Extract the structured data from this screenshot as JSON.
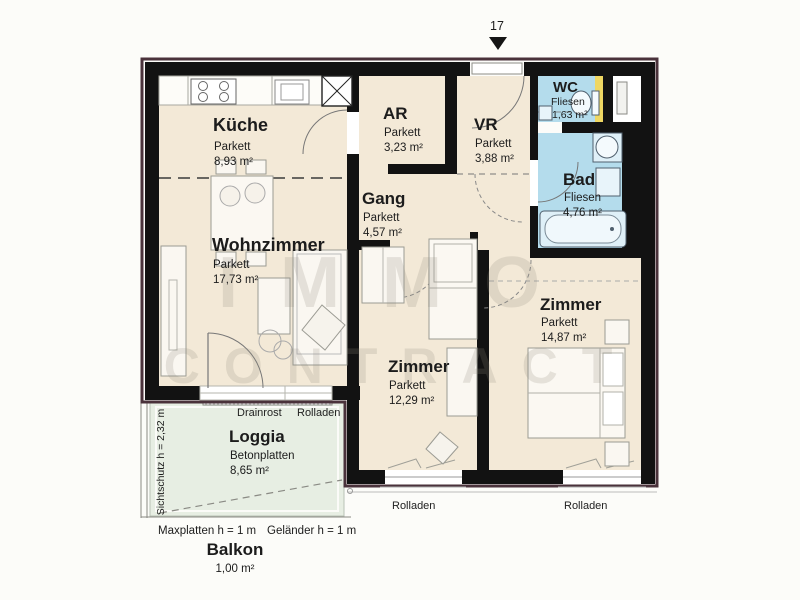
{
  "header": {
    "unit_number": "17"
  },
  "watermark": {
    "line1": "IMMO",
    "line2": "CONTRACT"
  },
  "rooms": {
    "kueche": {
      "name": "Küche",
      "floor": "Parkett",
      "area": "8,93 m²"
    },
    "wohnzimmer": {
      "name": "Wohnzimmer",
      "floor": "Parkett",
      "area": "17,73 m²"
    },
    "ar": {
      "name": "AR",
      "floor": "Parkett",
      "area": "3,23 m²"
    },
    "vr": {
      "name": "VR",
      "floor": "Parkett",
      "area": "3,88 m²"
    },
    "gang": {
      "name": "Gang",
      "floor": "Parkett",
      "area": "4,57 m²"
    },
    "wc": {
      "name": "WC",
      "floor": "Fliesen",
      "area": "1,63 m²"
    },
    "bad": {
      "name": "Bad",
      "floor": "Fliesen",
      "area": "4,76 m²"
    },
    "zimmer_klein": {
      "name": "Zimmer",
      "floor": "Parkett",
      "area": "12,29 m²"
    },
    "zimmer_gross": {
      "name": "Zimmer",
      "floor": "Parkett",
      "area": "14,87 m²"
    },
    "loggia": {
      "name": "Loggia",
      "floor": "Betonplatten",
      "area": "8,65 m²"
    },
    "balkon": {
      "name": "Balkon",
      "area": "1,00 m²"
    }
  },
  "annotations": {
    "drainrost": "Drainrost",
    "rolladen_top": "Rolladen",
    "sichtschutz": "Sichtschutz h = 2,32 m",
    "maxplatten": "Maxplatten h = 1 m",
    "gelaender": "Geländer h = 1 m",
    "rolladen_left": "Rolladen",
    "rolladen_right": "Rolladen"
  },
  "colors": {
    "wall": "#121212",
    "outer_outline": "#4a323b",
    "floor_parkett": "#f3e9d7",
    "floor_fliesen": "#b4dcec",
    "floor_loggia": "#e7eee3",
    "accent_yellow": "#efd763"
  }
}
